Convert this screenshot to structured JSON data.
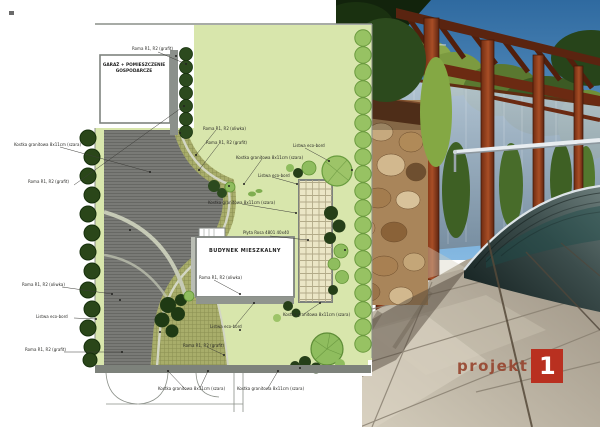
{
  "plan": {
    "garage_label": "GARAŻ + POMIESZCZENIE GOSPODARCZE",
    "building_label": "BUDYNEK MIESZKALNY",
    "labels": [
      {
        "text": "Roma R1, R2 (grafit)"
      },
      {
        "text": "Kostka granitowa 8x11cm (szara)"
      },
      {
        "text": "Roma R1, R2 (grafit)"
      },
      {
        "text": "Roma R1, R2 (oliwka)"
      },
      {
        "text": "Roma R1, R2 (grafit)"
      },
      {
        "text": "Kostka granitowa 8x11cm (szara)"
      },
      {
        "text": "Listwa eco-bord"
      },
      {
        "text": "Listwa eco-bord"
      },
      {
        "text": "Kostka granitowa 8x11cm (szara)"
      },
      {
        "text": "Płyta Rosa 4801 40x40"
      },
      {
        "text": "Roma R1, R2 (oliwka)"
      },
      {
        "text": "Roma R1, R2 (oliwka)"
      },
      {
        "text": "Listwa eco-bord"
      },
      {
        "text": "Roma R1, R2 (grafit)"
      },
      {
        "text": "Listwa eco-bord"
      },
      {
        "text": "Roma R1, R2 (grafit)"
      },
      {
        "text": "Kostka granitowa 8x11cm (szara)"
      },
      {
        "text": "Kostka granitowa 8x11cm (szara)"
      },
      {
        "text": "Kostka granitowa 8x11cm (szara)"
      }
    ],
    "colors": {
      "lawn": "#d8e6ac",
      "paving_dark": "#797a76",
      "paving_olive": "#a8ad6a",
      "paving_light": "#d3d6c4",
      "terrace": "#ebe6c6",
      "tree_light": "#97c263",
      "tree_dark": "#2a4619",
      "wall_grey": "#7d827b"
    }
  },
  "photo": {
    "colors": {
      "sky": "#2f6aa0",
      "pergola_wood": "#8a3a1a",
      "stone_wall": "#b08a5c",
      "paving": "#bfb8a8",
      "pool_dome": "#2a3a3a",
      "handrail_steel": "#e8edf1"
    }
  },
  "logo": {
    "text": "projekt",
    "number": "1",
    "text_color": "#96422c",
    "square_color": "#b93020"
  }
}
